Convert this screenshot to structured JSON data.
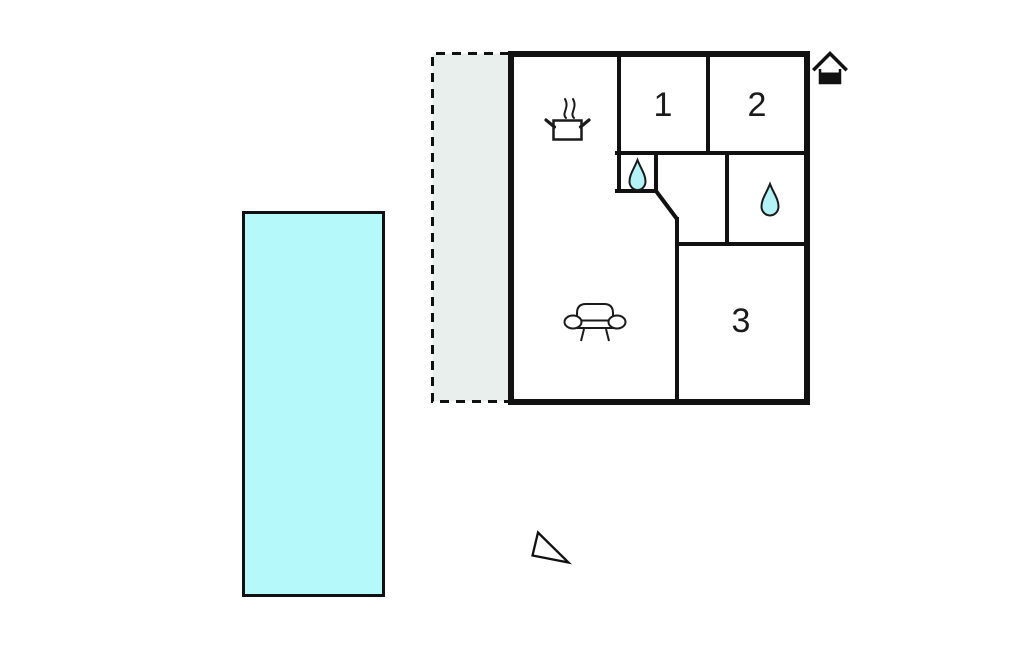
{
  "page": {
    "background": "#ffffff",
    "type": "floor-plan"
  },
  "colors": {
    "pool": "#b5f9fb",
    "terrace": "#e8efec",
    "water_drop": "#b3f2f7",
    "wall": "#111111",
    "label_text": "#1a1a1a"
  },
  "floor_plan": {
    "rooms": [
      {
        "label": "1",
        "name": "room-1"
      },
      {
        "label": "2",
        "name": "room-2"
      },
      {
        "label": "3",
        "name": "room-3"
      }
    ],
    "features": [
      {
        "name": "swimming-pool"
      },
      {
        "name": "terrace",
        "style": "dashed-outline"
      },
      {
        "name": "kitchen",
        "icon": "cooking-pot-icon"
      },
      {
        "name": "bathroom-small",
        "icon": "water-drop-icon"
      },
      {
        "name": "bathroom-large",
        "icon": "water-drop-icon"
      },
      {
        "name": "living-room",
        "icon": "sofa-icon"
      },
      {
        "name": "entrance-marker",
        "icon": "house-icon"
      },
      {
        "name": "orientation-marker",
        "icon": "north-arrow-icon"
      }
    ]
  }
}
